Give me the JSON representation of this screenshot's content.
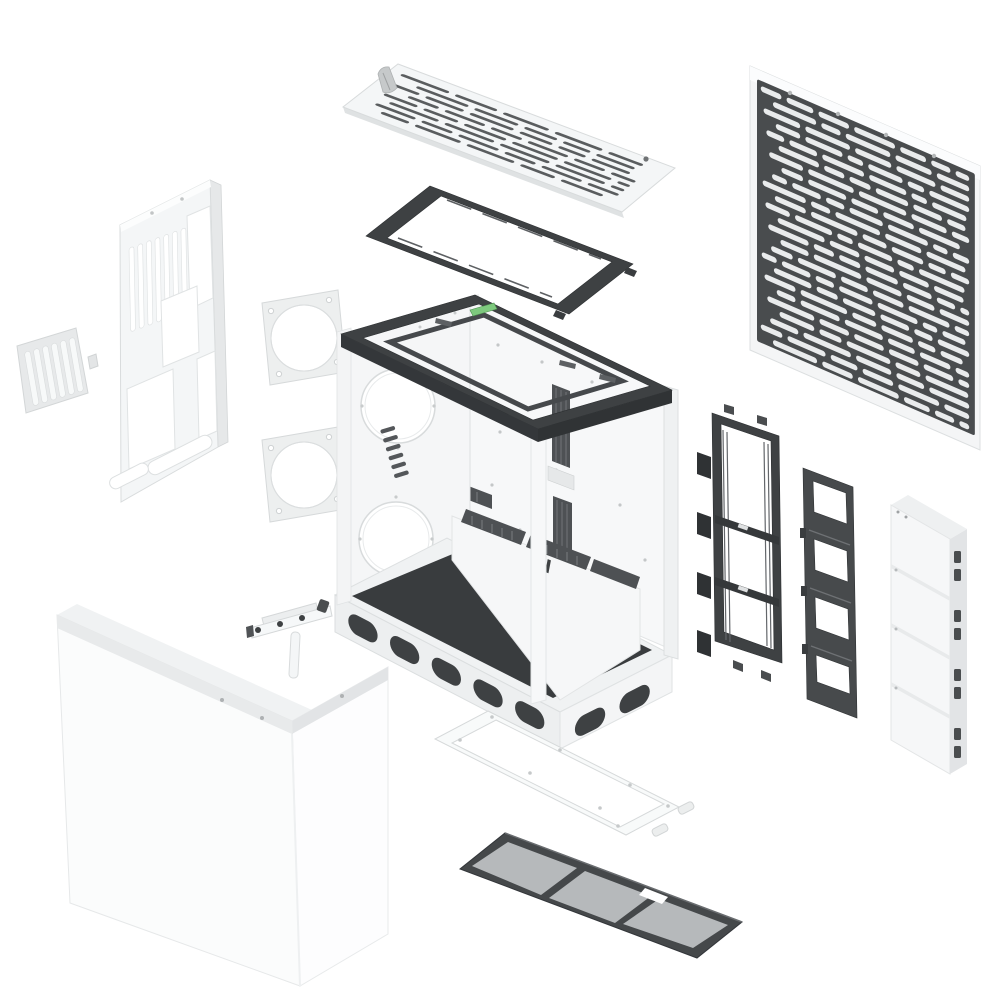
{
  "page": {
    "background": "#ffffff"
  },
  "brand": {
    "mark": "N"
  },
  "colors": {
    "page_bg": "#ffffff",
    "white_part": "#f5f6f7",
    "white_bright": "#fcfdfd",
    "edge_light": "#d8dbdc",
    "shade_light": "#e7e9ea",
    "dark_frame": "#3e4143",
    "dark_mid": "#54575a",
    "mesh_dark": "#494c4e",
    "mesh_hole": "#e9ebec",
    "slot_dark": "#5a5d5f",
    "filter_mesh": "#b6b9bb",
    "floor_dark": "#393c3e",
    "accent_green": "#7ec97e",
    "screw_grey": "#c2c5c6"
  },
  "parts": [
    {
      "id": "top-vent-panel",
      "label": "Top vent panel"
    },
    {
      "id": "top-radiator-bracket",
      "label": "Top radiator bracket"
    },
    {
      "id": "chassis-frame",
      "label": "Main chassis frame"
    },
    {
      "id": "front-mesh-panel",
      "label": "Front mesh panel"
    },
    {
      "id": "rear-io-panel",
      "label": "Rear panel"
    },
    {
      "id": "pci-slot-grille",
      "label": "Vent grille"
    },
    {
      "id": "fan-gasket-top",
      "label": "Fan gasket"
    },
    {
      "id": "fan-gasket-bottom",
      "label": "Fan gasket"
    },
    {
      "id": "side-panel",
      "label": "Wrap-around side panel"
    },
    {
      "id": "gpu-support-bracket",
      "label": "Support bracket"
    },
    {
      "id": "fan-mount-bracket",
      "label": "Fan mount bracket"
    },
    {
      "id": "drive-bracket",
      "label": "Drive bracket"
    },
    {
      "id": "cable-cover-stack",
      "label": "Cable cover stack"
    },
    {
      "id": "bottom-filter-frame",
      "label": "Bottom filter frame"
    },
    {
      "id": "bottom-dust-filter",
      "label": "Bottom dust filter"
    }
  ]
}
